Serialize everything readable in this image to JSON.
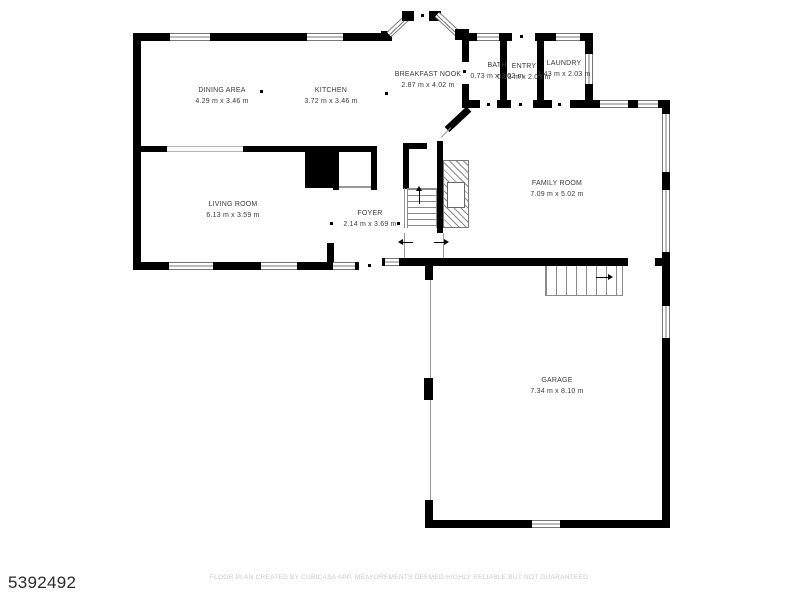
{
  "plan": {
    "id_number": "5392492",
    "footer": "FLOOR PLAN CREATED BY CUBICASA APP. MEASUREMENTS DEEMED HIGHLY RELIABLE BUT NOT GUARANTEED."
  },
  "rooms": {
    "dining": {
      "name": "DINING AREA",
      "dims": "4.29 m x 3.46 m"
    },
    "kitchen": {
      "name": "KITCHEN",
      "dims": "3.72 m x 3.46 m"
    },
    "breakfast_nook": {
      "name": "BREAKFAST NOOK",
      "dims": "2.87 m x 4.02 m"
    },
    "bath": {
      "name": "BATH",
      "dims": "0.73 m x 2.02 m"
    },
    "entry": {
      "name": "ENTRY",
      "dims": "0.93 m x 2.03 m"
    },
    "laundry": {
      "name": "LAUNDRY",
      "dims": "1.43 m x 2.03 m"
    },
    "living": {
      "name": "LIVING ROOM",
      "dims": "6.13 m x 3.59 m"
    },
    "foyer": {
      "name": "FOYER",
      "dims": "2.14 m x 3.69 m"
    },
    "family": {
      "name": "FAMILY ROOM",
      "dims": "7.09 m x 5.02 m"
    },
    "garage": {
      "name": "GARAGE",
      "dims": "7.34 m x 8.10 m"
    }
  },
  "colors": {
    "wall": "#000000",
    "label_text": "#3a3a3a",
    "footer_text": "#c8c8c8",
    "background": "#ffffff"
  }
}
